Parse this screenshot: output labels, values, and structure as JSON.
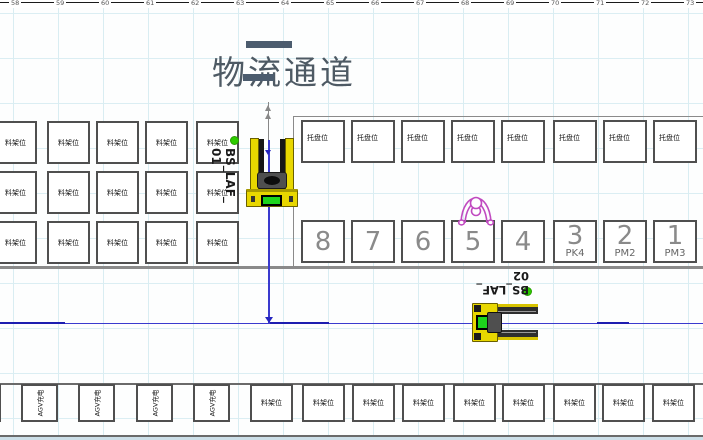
{
  "ruler_ticks": [
    "58",
    "59",
    "60",
    "61",
    "62",
    "63",
    "64",
    "65",
    "66",
    "67",
    "68",
    "69",
    "70",
    "71",
    "72",
    "73"
  ],
  "title": "物流通道",
  "rack_label": "料架位",
  "pallet_label": "托盘位",
  "agv_label": "AGV充电",
  "left_grid": {
    "rows": 3,
    "cols": 5
  },
  "pallet_row": {
    "count": 8
  },
  "slots": [
    {
      "num": "8",
      "sub": ""
    },
    {
      "num": "7",
      "sub": ""
    },
    {
      "num": "6",
      "sub": ""
    },
    {
      "num": "5",
      "sub": ""
    },
    {
      "num": "4",
      "sub": ""
    },
    {
      "num": "3",
      "sub": "PK4"
    },
    {
      "num": "2",
      "sub": "PM2"
    },
    {
      "num": "1",
      "sub": "PM3"
    }
  ],
  "machines": [
    {
      "id": "bs-laf-01",
      "label_lines": [
        "BS_LAF_",
        "01"
      ]
    },
    {
      "id": "bs-laf-02",
      "label_lines": [
        "BS_LAF_",
        "02"
      ]
    }
  ],
  "agv_row": {
    "count": 5
  },
  "bottom_rack_row": {
    "count": 9
  },
  "colors": {
    "machine_yellow": "#e8d700",
    "screen_green": "#1dd41d",
    "path_blue": "#3a3ace",
    "status_dot_green": "#2ecc00",
    "operator_magenta": "#c04ac0",
    "conveyor_slate": "#4c5c6e"
  }
}
